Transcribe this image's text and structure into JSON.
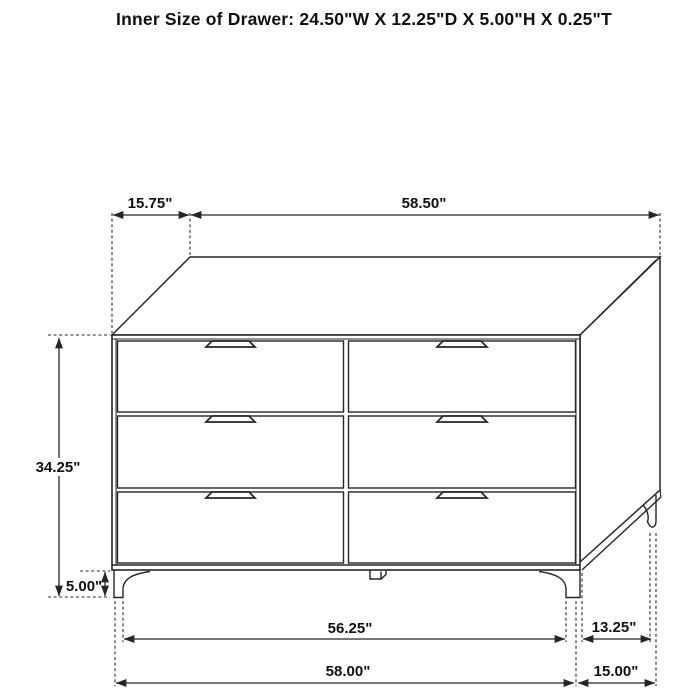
{
  "title": "Inner Size of Drawer: 24.50\"W X 12.25\"D X 5.00\"H X 0.25\"T",
  "diagram": {
    "subject": "six-drawer dresser technical dimension drawing",
    "style": {
      "line_color": "#262626",
      "background": "#ffffff",
      "text_color": "#111111"
    }
  },
  "dims": {
    "top_depth": "15.75\"",
    "top_width": "58.50\"",
    "drawer_width": "28.25\"",
    "drawer_height": "9.00\"",
    "cabinet_height": "34.25\"",
    "leg_height": "5.00\"",
    "feet_inner_span": "56.25\"",
    "overall_width": "58.00\"",
    "side_feet_span": "13.25\"",
    "overall_depth": "15.00\""
  }
}
